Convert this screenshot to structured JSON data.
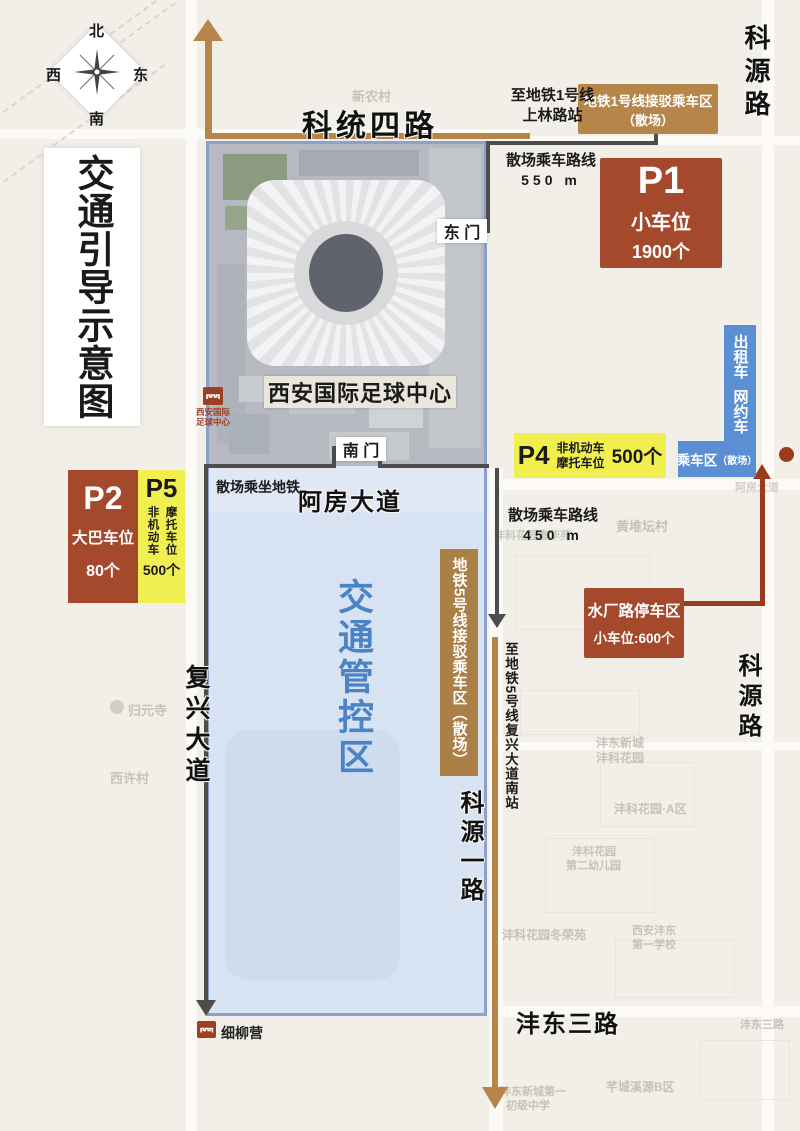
{
  "title": "交通引导示意图",
  "compass": {
    "n": "北",
    "e": "东",
    "s": "南",
    "w": "西"
  },
  "roads": {
    "ketong4": "科统四路",
    "keyuan_top": "科源路",
    "keyuan_mid": "科源路",
    "afang": "阿房大道",
    "fuxing": "复兴大道",
    "keyuan1": "科源一路",
    "fengdong3": "沣东三路"
  },
  "zone_label": "交通管控区",
  "stadium_label": "西安国际足球中心",
  "gates": {
    "east": "东 门",
    "south": "南 门"
  },
  "p1": {
    "id": "P1",
    "type": "小车位",
    "count": "1900个"
  },
  "p2": {
    "id": "P2",
    "type": "大巴车位",
    "count": "80个"
  },
  "p5": {
    "id": "P5",
    "col_left": "非机动车",
    "col_right": "摩托车位",
    "count": "500个"
  },
  "p4": {
    "id": "P4",
    "line1": "非机动车",
    "line2": "摩托车位",
    "count": "500个"
  },
  "waterplant": {
    "name": "水厂路停车区",
    "detail": "小车位:600个"
  },
  "metro1_box": {
    "line1": "地铁1号线接驳乘车区",
    "line2": "（散场）"
  },
  "metro5_box": "地铁5号线接驳乘车区（散场）",
  "taxi": {
    "v1": "出租车",
    "v2": "网约车",
    "main": "乘车区",
    "sub": "（散场）"
  },
  "routes": {
    "to_line1_l1": "至地铁1号线",
    "to_line1_l2": "上林路站",
    "walk550_l1": "散场乘车路线",
    "walk550_l2": "550 m",
    "walk450_l1": "散场乘车路线",
    "walk450_l2": "450 m",
    "subway_walk": "散场乘坐地铁",
    "to_line5": "至地铁5号线复兴大道南站"
  },
  "stations": {
    "xiliuying": "细柳营",
    "stadium_l1": "西安国际",
    "stadium_l2": "足球中心"
  },
  "colors": {
    "brown": "#b5854a",
    "rust": "#a5492c",
    "yellow": "#f1ef50",
    "taxi_blue": "#5b8fd4",
    "zone_text_blue": "#4b84c4",
    "route_gray": "#4d4d4d",
    "dark_red": "#9c3a1e"
  },
  "map_labels": [
    "新农村",
    "归元寺",
    "西许村",
    "黄堆坛村",
    "沣东新城",
    "沣科花园",
    "沣科花园·A区",
    "沣科花园",
    "第二幼儿园",
    "沣科花园冬荣苑",
    "西安沣东",
    "第一学校",
    "沣东新城第一",
    "初级中学",
    "芊城溪源B区",
    "沣东三路",
    "阿房大道",
    "沣科花园春华苑"
  ]
}
